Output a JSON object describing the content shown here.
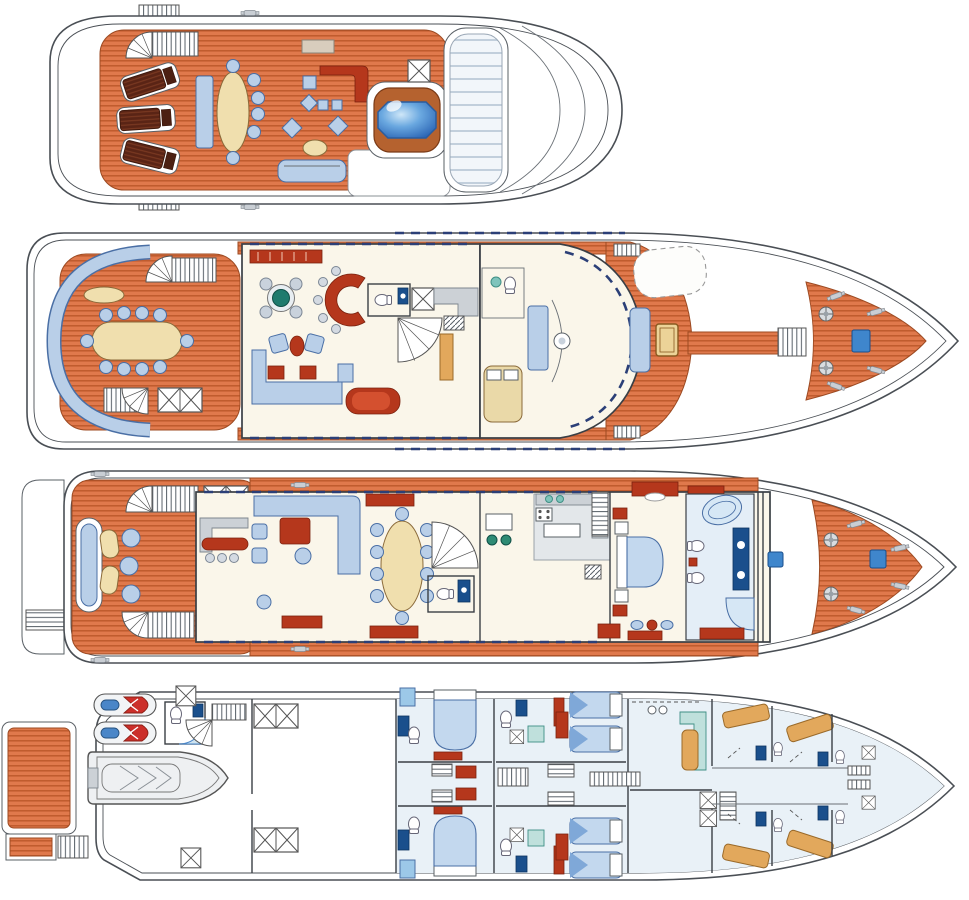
{
  "diagram": {
    "type": "yacht-deck-plan",
    "orientation": "bow-right",
    "decks": [
      {
        "id": "sun-deck",
        "label": "Sun deck",
        "features": [
          "stairs",
          "sun-loungers",
          "dining-table-with-chairs",
          "wet-bar",
          "lounge-cushions",
          "sofa",
          "spa-pool",
          "deck-hatch",
          "forward-sun-pad-panel"
        ]
      },
      {
        "id": "upper-deck",
        "label": "Upper deck",
        "features": [
          "curved-aft-settee",
          "al-fresco-dining-table",
          "stairs",
          "deck-hatch",
          "sky-lounge",
          "games-table",
          "c-shaped-bar",
          "armchairs",
          "u-sofa",
          "chaise",
          "day-head",
          "spiral-stairs",
          "captain-cabin",
          "wheelhouse-helm-console",
          "sun-pad",
          "skylight",
          "foredeck-windlasses",
          "anchor-hatch"
        ]
      },
      {
        "id": "main-deck",
        "label": "Main deck",
        "features": [
          "swim-platform",
          "aft-deck-seating",
          "stairs",
          "deck-hatches",
          "main-salon-seating",
          "bar-counter",
          "formal-dining-table",
          "credenzas",
          "foyer-spiral-stairs",
          "day-head",
          "breakfast-dinette",
          "galley",
          "master-stateroom-bed",
          "vanity",
          "his-and-hers-bathroom",
          "bathtub",
          "shower",
          "foredeck-hatches",
          "windlasses"
        ]
      },
      {
        "id": "lower-deck",
        "label": "Lower deck",
        "features": [
          "swim-platform",
          "boarding-ladder",
          "jet-skis",
          "rib-tender",
          "garage-shower-room",
          "stairs",
          "engine-room-hatches",
          "double-guest-cabins",
          "twin-guest-cabins",
          "guest-bathrooms",
          "central-lobby-stairs",
          "crew-mess",
          "crew-bunk-cabins",
          "crew-bathrooms",
          "forepeak-ladder"
        ]
      }
    ]
  },
  "palette": {
    "hull_line": "#4a4f55",
    "teak": "#e0794c",
    "teak_stripe": "#bf5a2d",
    "teak_edge": "#9c4a22",
    "ivory": "#faf6ea",
    "pale_blue_floor": "#e9f1f7",
    "light_blue": "#b9cfe8",
    "mid_blue": "#c3d8ee",
    "steel_blue": "#4a6fa5",
    "navy": "#1a4f8c",
    "window_navy": "#2b3f77",
    "dark_red": "#b5371c",
    "red": "#cc2f2a",
    "cream": "#f0dfae",
    "tan": "#e2a85c",
    "teal_green": "#1e7b6e",
    "teal_light": "#bfe0dc",
    "gray": "#ccd1d6",
    "gray_line": "#9aa7b5",
    "pool_blue": "#2a64b4",
    "brown": "#5a2415",
    "brown_stripe": "#7c3a22",
    "white": "#ffffff"
  }
}
